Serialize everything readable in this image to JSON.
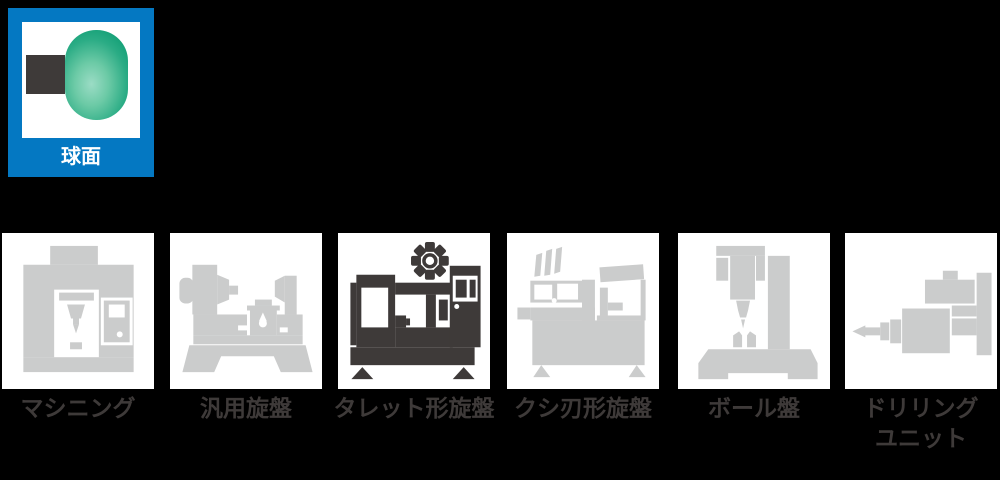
{
  "shape_selector": {
    "label": "球面",
    "tile_color": "#0478C2",
    "sphere_color_light": "#9BDCC5",
    "sphere_color_dark": "#14A077",
    "square_color": "#3E3A39"
  },
  "machine_selector": {
    "active_icon_color": "#3E3A39",
    "inactive_icon_color": "#CBCCCC",
    "label_color": "#3E3A39",
    "machines": [
      {
        "label": "マシニング",
        "name": "machining-center",
        "active": false
      },
      {
        "label": "汎用旋盤",
        "name": "engine-lathe",
        "active": false
      },
      {
        "label": "タレット形旋盤",
        "name": "turret-lathe",
        "active": true
      },
      {
        "label": "クシ刃形旋盤",
        "name": "gang-tool-lathe",
        "active": false
      },
      {
        "label": "ボール盤",
        "name": "drill-press",
        "active": false
      },
      {
        "label": "ドリリング\nユニット",
        "name": "drilling-unit",
        "active": false
      }
    ]
  }
}
